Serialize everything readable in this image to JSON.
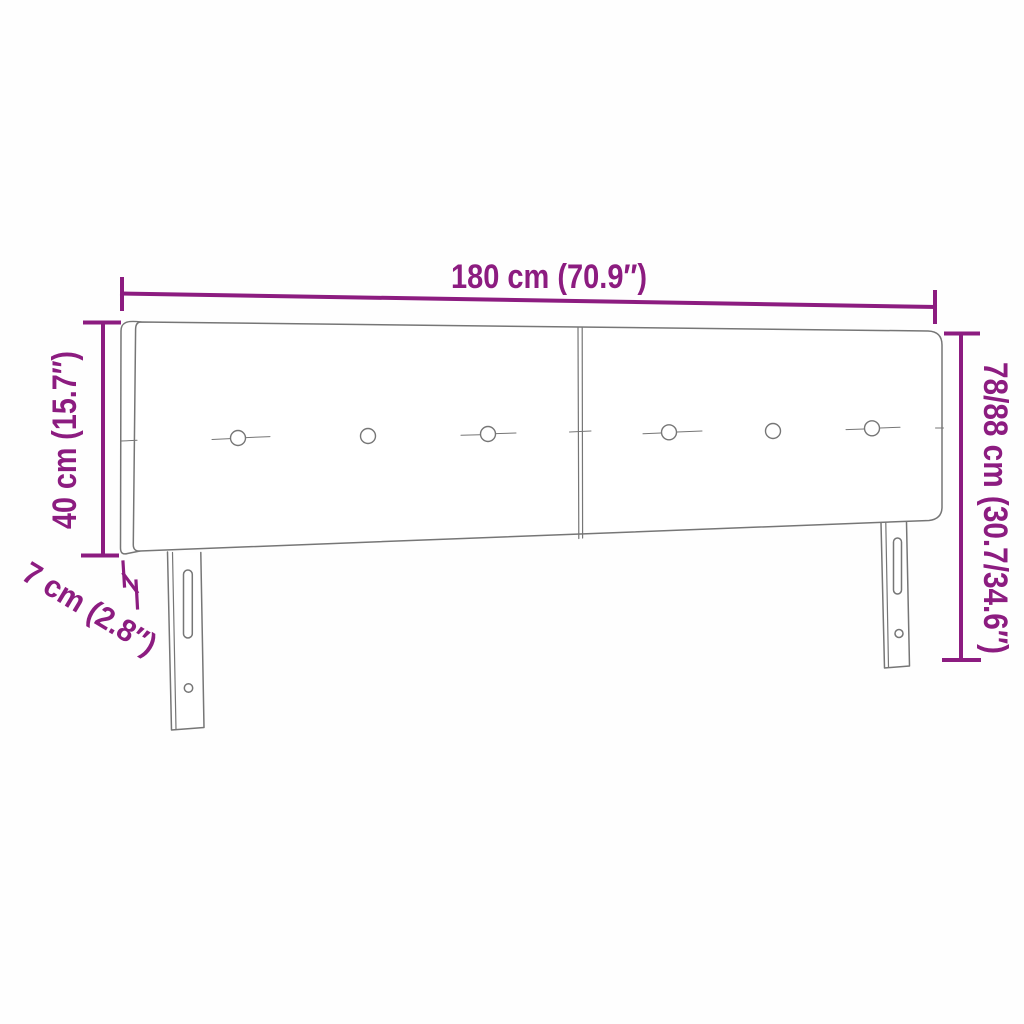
{
  "diagram": {
    "type": "product-dimension-diagram",
    "subject": "upholstered-headboard-with-two-panels-and-two-legs",
    "background_color": "#fefefe",
    "accent_color": "#8C1C80",
    "line_color": "#767676",
    "crease_color": "#9a9a9a",
    "dimensions": {
      "width": "180 cm (70.9″)",
      "panel_height": "40 cm (15.7″)",
      "total_height": "78/88 cm (30.7/34.6″)",
      "depth": "7 cm (2.8″)"
    }
  }
}
